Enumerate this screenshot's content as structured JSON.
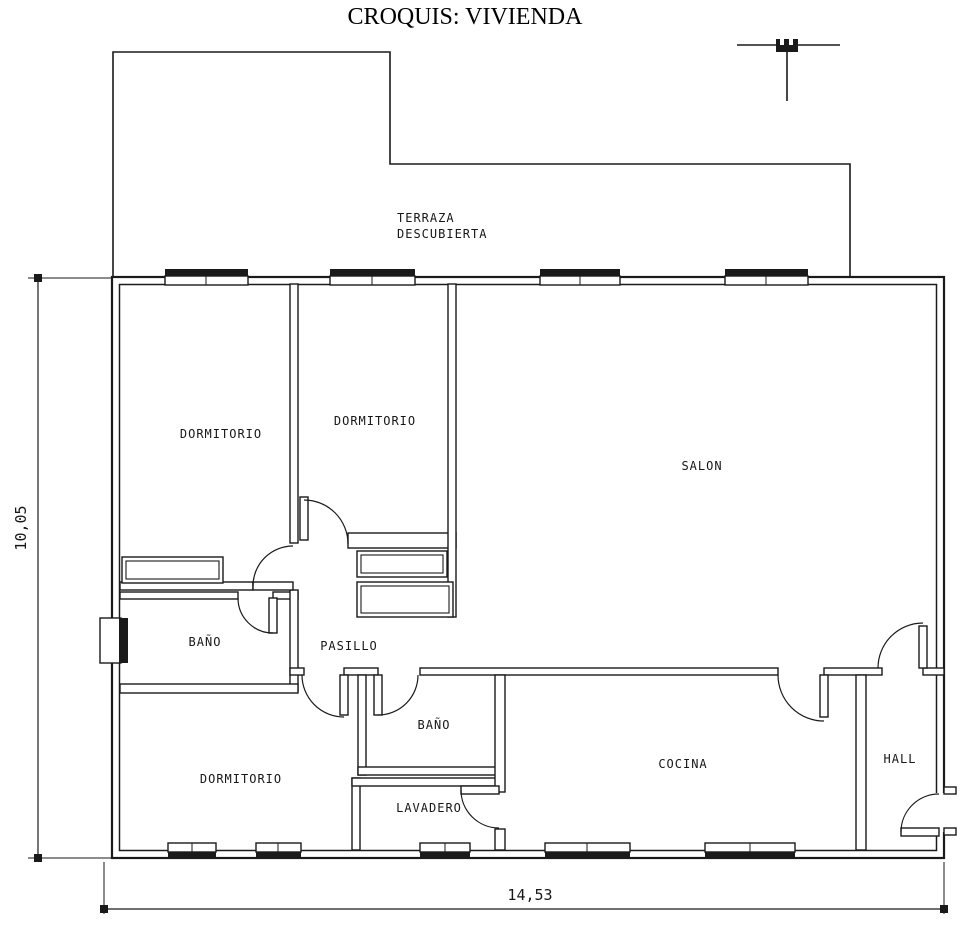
{
  "title": "CROQUIS: VIVIENDA",
  "terrace": {
    "line1": "TERRAZA",
    "line2": "DESCUBIERTA"
  },
  "rooms": {
    "dormitorio1": "DORMITORIO",
    "dormitorio2": "DORMITORIO",
    "dormitorio3": "DORMITORIO",
    "salon": "SALON",
    "bano1": "BAÑO",
    "bano2": "BAÑO",
    "pasillo": "PASILLO",
    "cocina": "COCINA",
    "lavadero": "LAVADERO",
    "hall": "HALL"
  },
  "dimensions": {
    "width": "14,53",
    "height": "10,05"
  },
  "colors": {
    "line": "#1a1a1a",
    "background": "#ffffff"
  }
}
